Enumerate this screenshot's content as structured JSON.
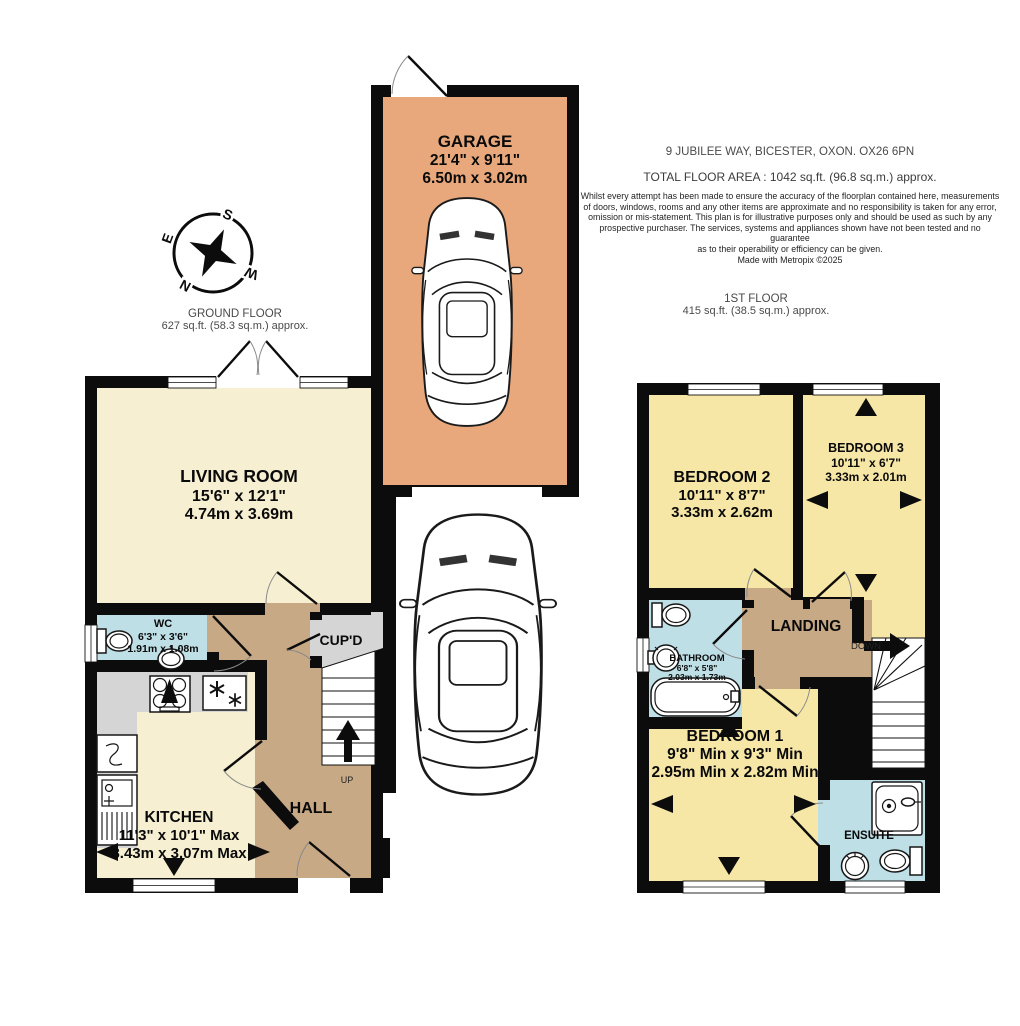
{
  "header": {
    "address": "9 JUBILEE WAY, BICESTER, OXON. OX26 6PN",
    "total_area": "TOTAL FLOOR AREA : 1042 sq.ft. (96.8 sq.m.) approx.",
    "disclaimer_lines": [
      "Whilst every attempt has been made to ensure the accuracy of the floorplan contained here, measurements",
      "of doors, windows, rooms and any other items are approximate and no responsibility is taken for any error,",
      "omission or mis-statement. This plan is for illustrative purposes only and should be used as such by any",
      "prospective purchaser. The services, systems and appliances shown have not been tested and no guarantee",
      "as to their operability or efficiency can be given."
    ],
    "credit": "Made with Metropix ©2025"
  },
  "floor_labels": {
    "ground": {
      "title": "GROUND FLOOR",
      "area": "627 sq.ft. (58.3 sq.m.) approx."
    },
    "first": {
      "title": "1ST FLOOR",
      "area": "415 sq.ft. (38.5 sq.m.) approx."
    }
  },
  "rooms": {
    "garage": {
      "name": "GARAGE",
      "imperial": "21'4\" x 9'11\"",
      "metric": "6.50m x 3.02m"
    },
    "living_room": {
      "name": "LIVING ROOM",
      "imperial": "15'6\" x 12'1\"",
      "metric": "4.74m x 3.69m"
    },
    "wc": {
      "name": "WC",
      "imperial": "6'3\" x 3'6\"",
      "metric": "1.91m x 1.08m"
    },
    "kitchen": {
      "name": "KITCHEN",
      "imperial": "11'3\" x 10'1\" Max",
      "metric": "3.43m x 3.07m Max"
    },
    "hall": {
      "name": "HALL"
    },
    "cupboard": {
      "name": "CUP'D"
    },
    "bedroom2": {
      "name": "BEDROOM 2",
      "imperial": "10'11\" x 8'7\"",
      "metric": "3.33m x 2.62m"
    },
    "bedroom3": {
      "name": "BEDROOM 3",
      "imperial": "10'11\" x 6'7\"",
      "metric": "3.33m x 2.01m"
    },
    "bathroom": {
      "name": "BATHROOM",
      "imperial": "6'8\" x 5'8\"",
      "metric": "2.03m x 1.73m"
    },
    "bedroom1": {
      "name": "BEDROOM 1",
      "imperial": "9'8\" Min x 9'3\" Min",
      "metric": "2.95m Min x 2.82m Min"
    },
    "landing": {
      "name": "LANDING"
    },
    "ensuite": {
      "name": "ENSUITE"
    }
  },
  "stairs": {
    "up": "UP",
    "down": "DOWN"
  },
  "compass": {
    "north": "N",
    "south": "S",
    "east": "E",
    "west": "W"
  },
  "colors": {
    "garage_floor": "#e8a87c",
    "living_kitchen_floor": "#f6efd1",
    "bedroom_floor": "#f7e7a7",
    "hall_landing_floor": "#c8a985",
    "wet_room_floor": "#bfdfe6",
    "cupboard_counter": "#d5d5d5",
    "walls": "#0c0c0c"
  }
}
